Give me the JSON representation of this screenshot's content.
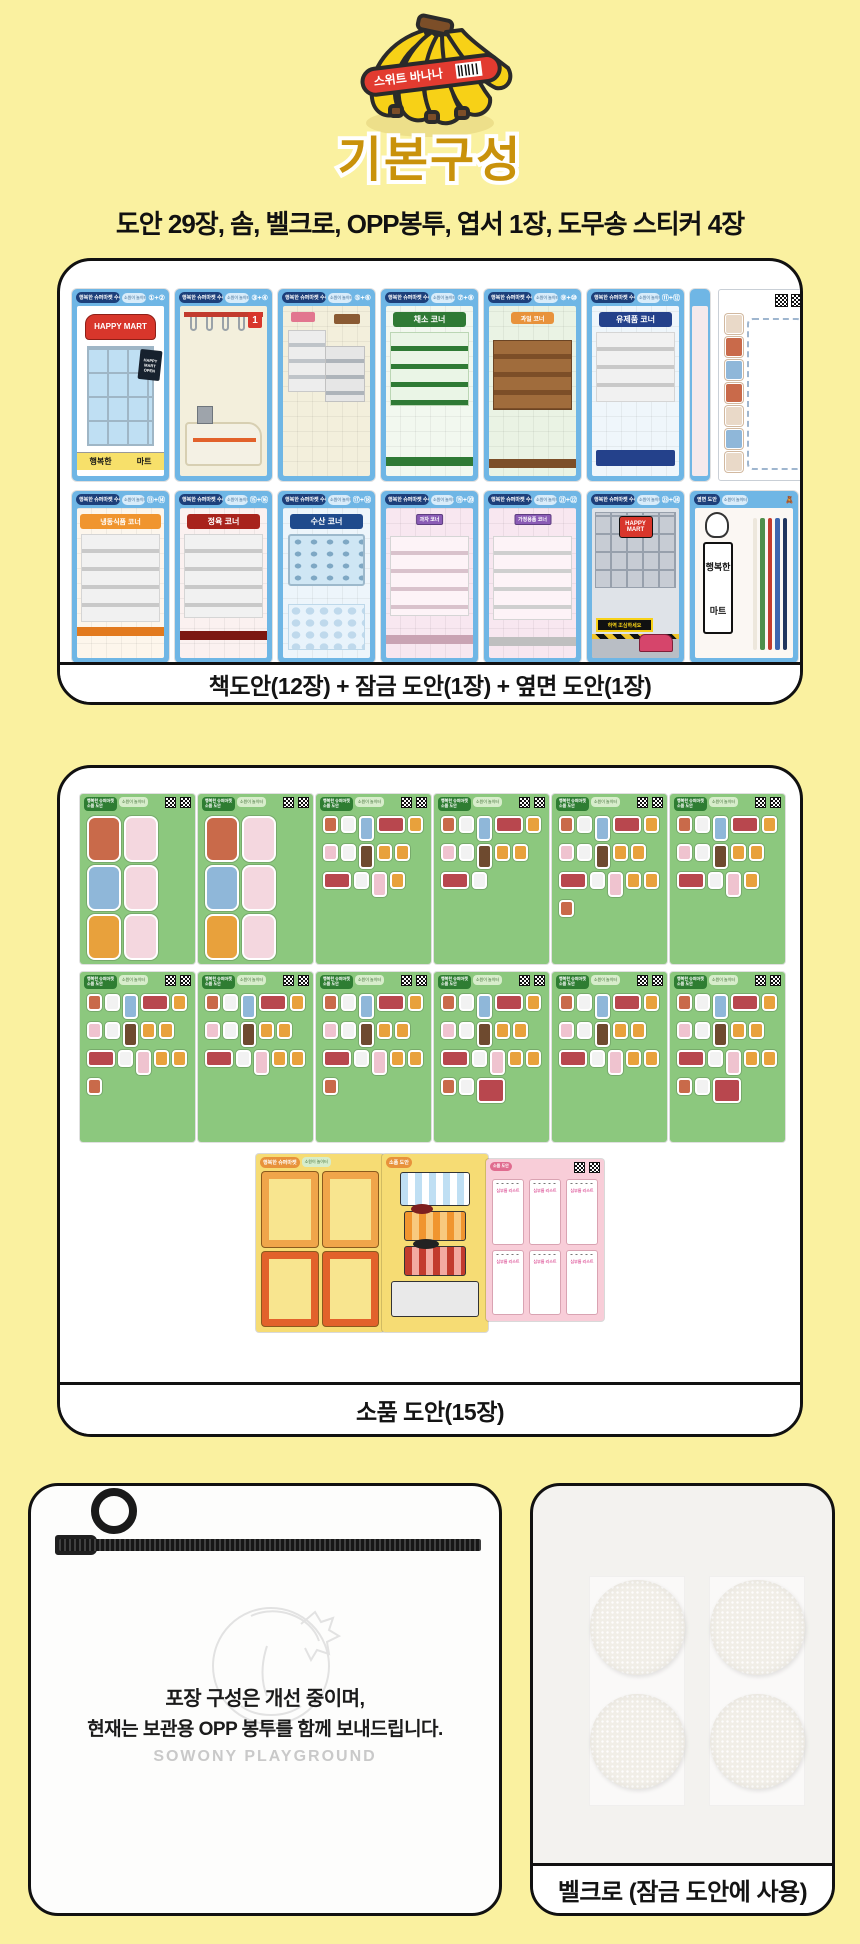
{
  "header": {
    "banana_band": "스위트 바나나",
    "title": "기본구성",
    "subtitle": "도안 29장, 솜, 벨크로, OPP봉투, 엽서 1장, 도무송 스티커 4장"
  },
  "card1": {
    "caption": "책도안(12장) + 잠금 도안(1장) + 옆면 도안(1장)",
    "header_label": "행복한 슈퍼마켓 수록 도안",
    "header_sub": "소원이 놀이터",
    "row1": [
      {
        "num": "①+②",
        "mart_sign": "HAPPY MART",
        "bottom_sign_left": "행복한",
        "bottom_sign_right": "마트",
        "poster": "HAPPY MART OPEN"
      },
      {
        "num": "③+④",
        "lane_number": "1"
      },
      {
        "num": "⑤+⑥"
      },
      {
        "num": "⑦+⑧",
        "banner": "채소 코너",
        "banner_color": "#2F7A35"
      },
      {
        "num": "⑨+⑩",
        "banner": "과일 코너",
        "banner_color": "#E8923B"
      },
      {
        "num": "⑪+⑫",
        "banner": "유제품 코너",
        "banner_color": "#24418B"
      }
    ],
    "row2": [
      {
        "num": "⑬+⑭",
        "banner": "냉동식품 코너",
        "banner_color": "#F0952F"
      },
      {
        "num": "⑮+⑯",
        "banner": "정육 코너",
        "banner_color": "#A8231C"
      },
      {
        "num": "⑰+⑱",
        "banner": "수산 코너",
        "banner_color": "#1F4A8C"
      },
      {
        "num": "⑲+⑳",
        "minisign": "과자 코너"
      },
      {
        "num": "㉑+㉒",
        "minisign": "가정용품 코너"
      },
      {
        "num": "㉓+㉔",
        "mart_sign": "HAPPY MART",
        "hazard_sign": "하역 조심하세요",
        "parking": "P"
      },
      {
        "side_header": "옆면 도안",
        "sign_top": "행복한",
        "sign_bottom": "마트"
      }
    ]
  },
  "card2": {
    "caption": "소품 도안(15장)",
    "sheet_label_line1": "행복한 슈퍼마켓",
    "sheet_label_line2": "소품 도안",
    "sheet_sub": "소원이 놀이터",
    "memo_pad_label": "심부름 리스트"
  },
  "opp_card": {
    "line1": "포장 구성은 개선 중이며,",
    "line2": "현재는 보관용 OPP 봉투를 함께 보내드립니다.",
    "brand": "SOWONY PLAYGROUND"
  },
  "velcro_card": {
    "caption": "벨크로 (잠금 도안에 사용)"
  }
}
